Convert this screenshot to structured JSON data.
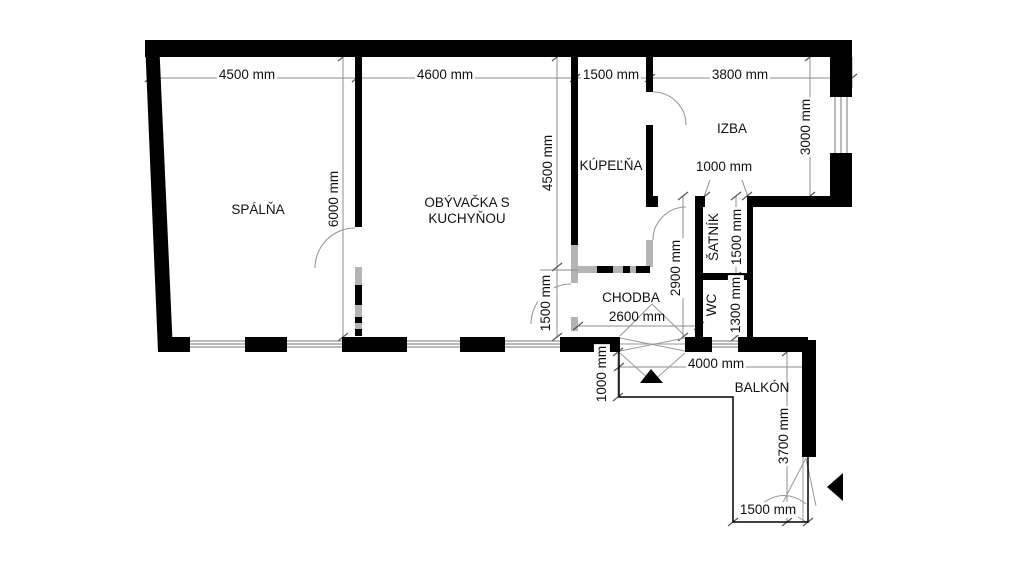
{
  "rooms": {
    "spalna": "SPÁLŇA",
    "obyvacka": "OBÝVAČKA S KUCHYŇOU",
    "kupelna": "KÚPEĽŇA",
    "izba": "IZBA",
    "chodba": "CHODBA",
    "satnik": "ŠATNÍK",
    "wc": "WC",
    "balkon": "BALKÓN"
  },
  "dimensions": {
    "spalna_width": "4500 mm",
    "obyvacka_width": "4600 mm",
    "kupelna_width": "1500 mm",
    "izba_width": "3800 mm",
    "spalna_depth": "6000 mm",
    "obyvacka_depth": "4500 mm",
    "obyvacka_opening": "1500 mm",
    "chodba_width": "2600 mm",
    "chodba_depth": "2900 mm",
    "satnik_depth": "1500 mm",
    "wc_depth": "1300 mm",
    "izba_window": "3000 mm",
    "izba_door": "1000 mm",
    "balkon_width": "4000 mm",
    "balkon_step": "1000 mm",
    "balkon_depth": "3700 mm",
    "balkon_door": "1500 mm"
  },
  "colors": {
    "wall": "#000000",
    "partial_wall": "#b4b4b4",
    "dimension_line": "#8c8c8c",
    "background": "#ffffff",
    "text": "#111111"
  }
}
